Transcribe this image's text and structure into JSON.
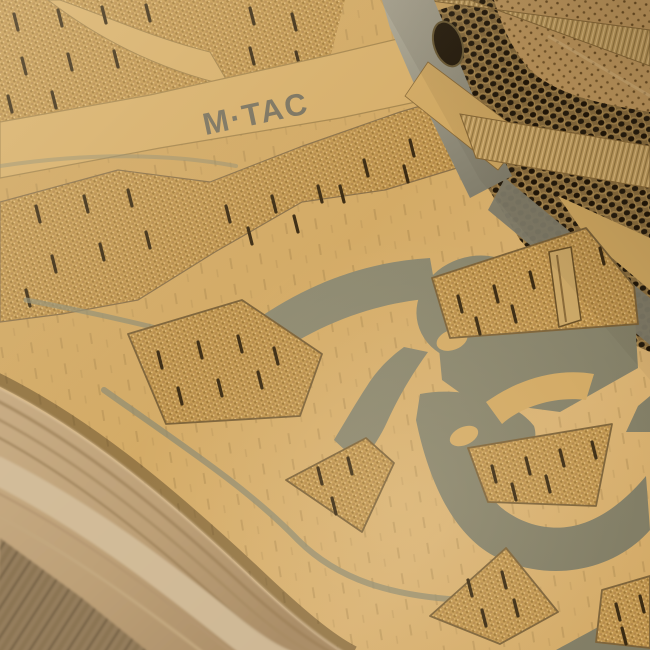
{
  "image": {
    "type": "product-photo-closeup",
    "subject": "Coyote-tan tactical sneaker upper, macro side view",
    "elements": "knit mesh windows with ventilation slits, printed olive swoosh shapes, perforated tongue, laces, foam midsole"
  },
  "brand": {
    "label": "M·TAC"
  },
  "palette": {
    "coyote": "#d4ab66",
    "knit_gold": "#c2974f",
    "olive_print": "#8f8b70",
    "mesh_dark": "#241a0c",
    "sole_beige": "#bfa27e",
    "slit_dark": "#3a2a12",
    "logo_gray": "#6a685c"
  }
}
